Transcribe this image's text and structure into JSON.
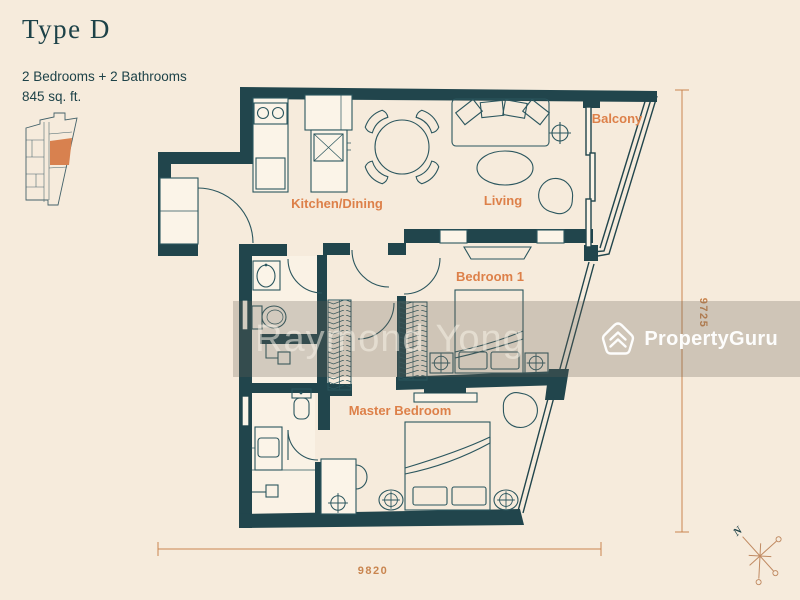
{
  "header": {
    "title": "Type D",
    "subtitle_line1": "2 Bedrooms + 2 Bathrooms",
    "subtitle_line2": "845 sq. ft."
  },
  "rooms": {
    "kitchen_dining": "Kitchen/Dining",
    "living": "Living",
    "balcony": "Balcony",
    "bedroom1": "Bedroom 1",
    "master_bedroom": "Master Bedroom"
  },
  "dimensions": {
    "height_mm": "9725",
    "width_mm": "9820"
  },
  "compass": {
    "north_label": "N"
  },
  "watermark": {
    "agent_name": "Raymond Yong",
    "brand": "PropertyGuru"
  },
  "colors": {
    "background": "#f6ebdc",
    "wall": "#21454c",
    "room_label": "#dd8049",
    "dimension_line": "#c9854f",
    "unit_highlight": "#d8814f",
    "watermark_band": "rgba(104,96,86,0.27)",
    "brand_text": "#ffffff"
  }
}
